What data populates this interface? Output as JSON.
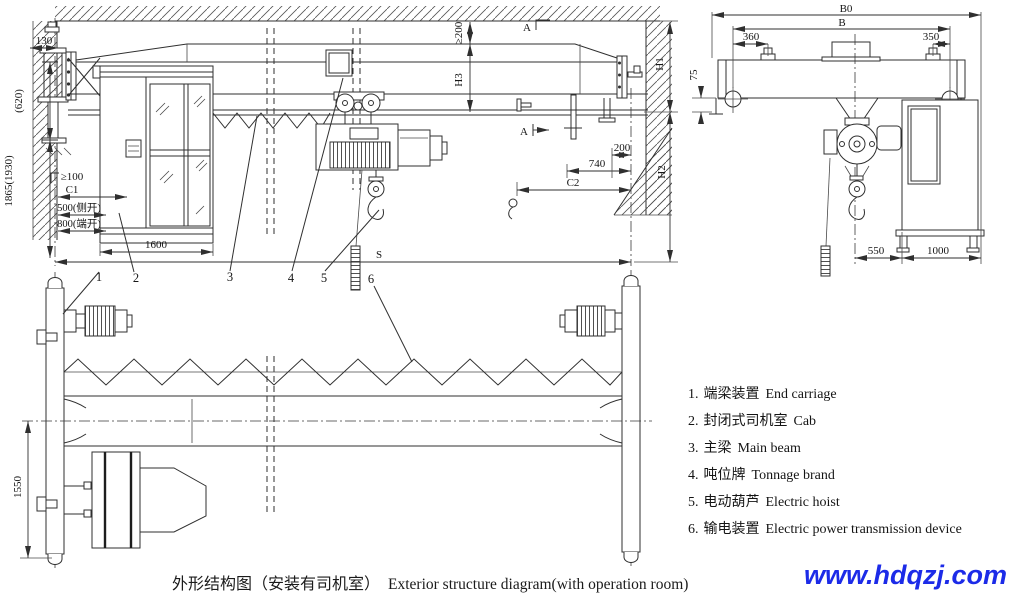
{
  "meta": {
    "line_color": "#2f2f2f",
    "background": "#ffffff"
  },
  "caption": {
    "zh": "外形结构图（安装有司机室）",
    "en": "Exterior structure diagram(with operation room)"
  },
  "website": {
    "text": "www.hdqzj.com",
    "color": "#1c2be8"
  },
  "legend": {
    "items": [
      {
        "no": "1.",
        "zh": "端梁装置",
        "en": "End carriage"
      },
      {
        "no": "2.",
        "zh": "封闭式司机室",
        "en": "Cab"
      },
      {
        "no": "3.",
        "zh": "主梁",
        "en": "Main beam"
      },
      {
        "no": "4.",
        "zh": "吨位牌",
        "en": "Tonnage brand"
      },
      {
        "no": "5.",
        "zh": "电动葫芦",
        "en": "Electric hoist"
      },
      {
        "no": "6.",
        "zh": "输电装置",
        "en": "Electric power transmission device"
      }
    ]
  },
  "callouts": [
    "1",
    "2",
    "3",
    "4",
    "5",
    "6"
  ],
  "fv": {
    "d130": "130",
    "d620": "(620)",
    "d1865": "1865(1930)",
    "dge100": "≥100",
    "c1": "C1",
    "d500": "500(侧开)",
    "d800": "800(端开)",
    "d1600": "1600",
    "dge200": "≥200",
    "h3": "H3",
    "h1": "H1",
    "h2": "H2",
    "d200": "200",
    "d740": "740",
    "c2": "C2",
    "s": "S",
    "a": "A"
  },
  "ev": {
    "b0": "B0",
    "b": "B",
    "d360": "360",
    "d350": "350",
    "d75": "75",
    "d550": "550",
    "d1000": "1000"
  },
  "pv": {
    "d1550": "1550"
  }
}
